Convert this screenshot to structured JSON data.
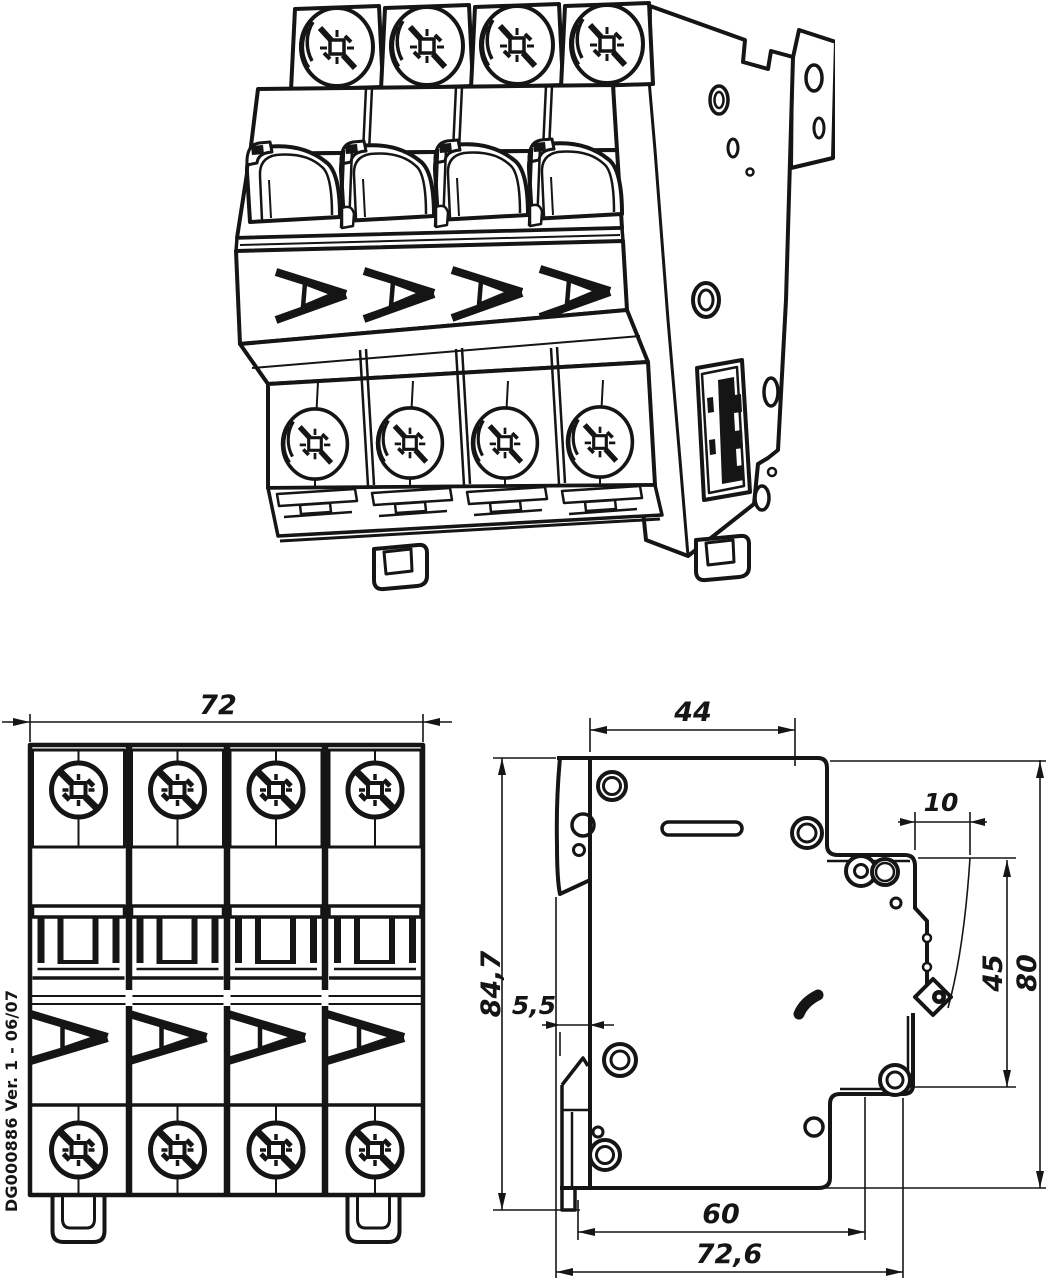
{
  "page": {
    "background_color": "#ffffff",
    "line_color": "#151515",
    "content": "Technical dimension drawing of a 4-pole DIN-rail miniature circuit breaker: isometric view, front view and side view"
  },
  "front_view": {
    "dim_width": "72",
    "serial_note": "DG000886 Ver. 1 - 06/07",
    "poles": 4
  },
  "side_view": {
    "dim_depth_top": "44",
    "dim_lip": "10",
    "dim_height_overall": "84,7",
    "dim_clip_offset": "5,5",
    "dim_recess_height": "45",
    "dim_height_body": "80",
    "dim_depth_rail": "60",
    "dim_depth_overall": "72,6"
  }
}
